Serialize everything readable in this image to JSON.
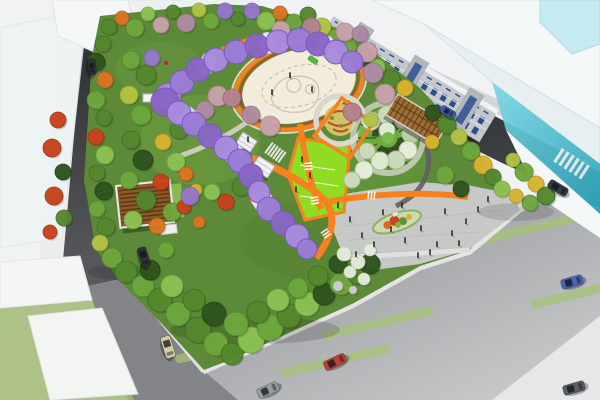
{
  "meta": {
    "scene_label": "aerial-render-urban-pocket-park-masterplan",
    "canvas": {
      "width": 600,
      "height": 400
    }
  },
  "palette": {
    "background": "#f1f2f3",
    "park_green": "#5d8a38",
    "lime_lawn": "#8fdc22",
    "path_orange": "#f5821e",
    "path_red_stripe": "#e03410",
    "plaza_cream": "#f2ecdb",
    "plaza_pattern": "#c9c2b0",
    "corner_plaza_gray": "#c7c9c7",
    "asphalt_dark": "#2b2d30",
    "road_mid": "#828487",
    "sidewalk": "#ececee",
    "median_green": "#a6c473",
    "glass_cyan": "#3fb6c9",
    "glass_white": "#f3f7f8",
    "facade_gray": "#c4c8cc",
    "window_blue": "#2e4f8e",
    "wood_brown": "#8a5a28",
    "pergola_wood": "#9c6830",
    "wisteria_light": "#a98ae0",
    "wisteria_mid": "#9b7cd8",
    "wisteria_dark": "#8a66c6",
    "people_dark": "#23252a",
    "trees": {
      "dk": {
        "f": "#2f541e",
        "s": "#24401a"
      },
      "g2": {
        "f": "#55882e",
        "s": "#3f6a22"
      },
      "g3": {
        "f": "#6ea83c",
        "s": "#54862c"
      },
      "g4": {
        "f": "#8cc254",
        "s": "#6da43c"
      },
      "yg": {
        "f": "#b4c445",
        "s": "#93a433"
      },
      "yl": {
        "f": "#d9b430",
        "s": "#b59423"
      },
      "or": {
        "f": "#dd7524",
        "s": "#b95a18"
      },
      "rd": {
        "f": "#c8431c",
        "s": "#a33314"
      },
      "pk": {
        "f": "#c9a2ac",
        "s": "#ab8390"
      },
      "pk2": {
        "f": "#b5838f",
        "s": "#966674"
      },
      "mv": {
        "f": "#b08ba4",
        "s": "#92708a"
      },
      "pu": {
        "f": "#9678cc",
        "s": "#7b5cb4"
      },
      "wh": {
        "f": "#e7ecdf",
        "s": "#c6d2b8"
      },
      "rk": {
        "f": "#cfd2cc",
        "s": "#aab0a8"
      }
    }
  },
  "scene": {
    "trees": [
      [
        109,
        27,
        8,
        "g2"
      ],
      [
        122,
        18,
        7,
        "or"
      ],
      [
        135,
        28,
        9,
        "g3"
      ],
      [
        148,
        14,
        7,
        "g4"
      ],
      [
        161,
        25,
        8,
        "pk"
      ],
      [
        173,
        12,
        7,
        "g2"
      ],
      [
        186,
        23,
        9,
        "mv"
      ],
      [
        199,
        10,
        7,
        "yg"
      ],
      [
        211,
        21,
        8,
        "g3"
      ],
      [
        225,
        11,
        8,
        "pu"
      ],
      [
        238,
        19,
        7,
        "g2"
      ],
      [
        252,
        11,
        8,
        "pu"
      ],
      [
        266,
        21,
        9,
        "g4"
      ],
      [
        280,
        13,
        7,
        "or"
      ],
      [
        294,
        22,
        8,
        "g3"
      ],
      [
        308,
        15,
        8,
        "g2"
      ],
      [
        322,
        27,
        9,
        "yg"
      ],
      [
        336,
        37,
        8,
        "g3"
      ],
      [
        103,
        44,
        8,
        "g2"
      ],
      [
        96,
        62,
        9,
        "dk"
      ],
      [
        105,
        80,
        8,
        "or"
      ],
      [
        96,
        100,
        9,
        "g3"
      ],
      [
        104,
        118,
        8,
        "g2"
      ],
      [
        96,
        137,
        8,
        "rd"
      ],
      [
        105,
        155,
        9,
        "g4"
      ],
      [
        97,
        173,
        8,
        "g2"
      ],
      [
        104,
        191,
        9,
        "dk"
      ],
      [
        97,
        209,
        8,
        "g3"
      ],
      [
        106,
        227,
        9,
        "g2"
      ],
      [
        100,
        243,
        8,
        "yg"
      ],
      [
        112,
        258,
        10,
        "g3"
      ],
      [
        126,
        272,
        11,
        "g2"
      ],
      [
        143,
        286,
        11,
        "g3"
      ],
      [
        160,
        300,
        12,
        "g2"
      ],
      [
        178,
        314,
        12,
        "g3"
      ],
      [
        198,
        330,
        13,
        "g2"
      ],
      [
        216,
        344,
        12,
        "g3"
      ],
      [
        232,
        354,
        11,
        "g2"
      ],
      [
        251,
        340,
        13,
        "g4"
      ],
      [
        270,
        328,
        13,
        "g3"
      ],
      [
        289,
        316,
        12,
        "g2"
      ],
      [
        307,
        304,
        12,
        "g4"
      ],
      [
        324,
        294,
        11,
        "dk"
      ],
      [
        341,
        284,
        11,
        "g3"
      ],
      [
        357,
        274,
        10,
        "g2"
      ],
      [
        370,
        264,
        10,
        "dk"
      ],
      [
        150,
        270,
        10,
        "dk"
      ],
      [
        172,
        286,
        11,
        "g4"
      ],
      [
        194,
        300,
        11,
        "g2"
      ],
      [
        214,
        314,
        12,
        "dk"
      ],
      [
        236,
        324,
        12,
        "g3"
      ],
      [
        258,
        312,
        11,
        "g2"
      ],
      [
        278,
        300,
        11,
        "g4"
      ],
      [
        298,
        288,
        10,
        "g3"
      ],
      [
        318,
        276,
        10,
        "g2"
      ],
      [
        338,
        264,
        9,
        "dk"
      ],
      [
        344,
        254,
        7,
        "wh"
      ],
      [
        358,
        262,
        7,
        "wh"
      ],
      [
        370,
        250,
        6,
        "wh"
      ],
      [
        350,
        272,
        6,
        "wh"
      ],
      [
        364,
        279,
        6,
        "wh"
      ],
      [
        338,
        286,
        5,
        "rk"
      ],
      [
        353,
        290,
        4,
        "rk"
      ],
      [
        349,
        47,
        8,
        "g3"
      ],
      [
        363,
        57,
        9,
        "dk"
      ],
      [
        377,
        67,
        8,
        "g4"
      ],
      [
        391,
        79,
        9,
        "g2"
      ],
      [
        405,
        88,
        8,
        "yl"
      ],
      [
        433,
        113,
        8,
        "dk"
      ],
      [
        447,
        125,
        9,
        "g2"
      ],
      [
        459,
        137,
        8,
        "yg"
      ],
      [
        471,
        151,
        9,
        "g3"
      ],
      [
        483,
        165,
        9,
        "yl"
      ],
      [
        493,
        177,
        8,
        "g2"
      ],
      [
        502,
        189,
        8,
        "g4"
      ],
      [
        513,
        160,
        7,
        "yg"
      ],
      [
        524,
        172,
        9,
        "g3"
      ],
      [
        536,
        184,
        8,
        "yl"
      ],
      [
        546,
        196,
        9,
        "g2"
      ],
      [
        530,
        203,
        8,
        "g3"
      ],
      [
        516,
        196,
        7,
        "yl"
      ],
      [
        218,
        96,
        10,
        "pk"
      ],
      [
        205,
        110,
        9,
        "mv"
      ],
      [
        281,
        30,
        9,
        "pk"
      ],
      [
        311,
        27,
        9,
        "pk2"
      ],
      [
        345,
        32,
        9,
        "pk"
      ],
      [
        367,
        52,
        10,
        "pk"
      ],
      [
        373,
        73,
        10,
        "mv"
      ],
      [
        385,
        94,
        10,
        "pk"
      ],
      [
        352,
        112,
        9,
        "pk2"
      ],
      [
        251,
        115,
        9,
        "mv"
      ],
      [
        270,
        126,
        10,
        "pk"
      ],
      [
        232,
        98,
        9,
        "pk2"
      ],
      [
        360,
        34,
        8,
        "mv"
      ],
      [
        131,
        60,
        9,
        "g3"
      ],
      [
        146,
        75,
        10,
        "g2"
      ],
      [
        129,
        95,
        9,
        "yg"
      ],
      [
        141,
        115,
        10,
        "g3"
      ],
      [
        131,
        140,
        9,
        "g2"
      ],
      [
        143,
        160,
        10,
        "dk"
      ],
      [
        129,
        180,
        9,
        "g3"
      ],
      [
        146,
        200,
        10,
        "g2"
      ],
      [
        133,
        220,
        9,
        "g4"
      ],
      [
        157,
        226,
        8,
        "or"
      ],
      [
        172,
        212,
        9,
        "g3"
      ],
      [
        161,
        182,
        8,
        "rd"
      ],
      [
        176,
        162,
        9,
        "g4"
      ],
      [
        163,
        142,
        8,
        "yl"
      ],
      [
        179,
        130,
        9,
        "g2"
      ],
      [
        272,
        212,
        9,
        "g3"
      ],
      [
        257,
        197,
        8,
        "or"
      ],
      [
        241,
        187,
        9,
        "g2"
      ],
      [
        226,
        202,
        8,
        "rd"
      ],
      [
        212,
        192,
        8,
        "g4"
      ],
      [
        186,
        174,
        7,
        "or"
      ],
      [
        196,
        190,
        6,
        "yl"
      ],
      [
        184,
        207,
        7,
        "rd"
      ],
      [
        199,
        222,
        6,
        "or"
      ],
      [
        432,
        142,
        7,
        "yl"
      ],
      [
        371,
        120,
        7,
        "yg"
      ],
      [
        445,
        175,
        9,
        "g3"
      ],
      [
        461,
        189,
        8,
        "dk"
      ],
      [
        152,
        58,
        8,
        "pu"
      ],
      [
        190,
        196,
        9,
        "pu"
      ],
      [
        166,
        250,
        8,
        "g3"
      ],
      [
        58,
        120,
        8,
        "rd"
      ],
      [
        52,
        148,
        9,
        "rd"
      ],
      [
        63,
        172,
        8,
        "dk"
      ],
      [
        54,
        196,
        9,
        "rd"
      ],
      [
        64,
        218,
        8,
        "g2"
      ],
      [
        50,
        232,
        7,
        "rd"
      ]
    ],
    "wisteria_arc": [
      [
        168,
        96,
        13
      ],
      [
        182,
        82,
        12
      ],
      [
        198,
        70,
        12
      ],
      [
        216,
        60,
        12
      ],
      [
        236,
        52,
        12
      ],
      [
        257,
        46,
        12
      ],
      [
        278,
        42,
        12
      ],
      [
        299,
        40,
        12
      ],
      [
        318,
        44,
        12
      ],
      [
        336,
        52,
        12
      ],
      [
        352,
        62,
        11
      ]
    ],
    "wisteria_tunnel": [
      [
        165,
        102,
        14
      ],
      [
        179,
        113,
        12
      ],
      [
        194,
        124,
        12
      ],
      [
        210,
        136,
        12
      ],
      [
        226,
        148,
        12
      ],
      [
        240,
        161,
        12
      ],
      [
        251,
        176,
        12
      ],
      [
        259,
        192,
        11
      ],
      [
        269,
        209,
        12
      ],
      [
        283,
        223,
        12
      ],
      [
        297,
        236,
        12
      ],
      [
        307,
        249,
        10
      ]
    ],
    "tunnel_ribs": [
      [
        187,
        117,
        40
      ],
      [
        233,
        153,
        42
      ],
      [
        262,
        200,
        55
      ],
      [
        207,
        64,
        35
      ],
      [
        268,
        43,
        20
      ],
      [
        327,
        47,
        -20
      ]
    ],
    "cars": [
      [
        144,
        257,
        72,
        "#2e3237",
        20,
        9
      ],
      [
        168,
        347,
        73,
        "#d6cfa4",
        22,
        10
      ],
      [
        335,
        362,
        -25,
        "#bd4038",
        23,
        10
      ],
      [
        572,
        282,
        -16,
        "#4a66b0",
        22,
        10
      ],
      [
        558,
        188,
        31,
        "#34383f",
        21,
        9
      ],
      [
        448,
        112,
        31,
        "#3f5ea6",
        16,
        8
      ],
      [
        268,
        390,
        -25,
        "#9a9da2",
        22,
        10
      ],
      [
        574,
        388,
        -16,
        "#5a5d62",
        22,
        10
      ],
      [
        92,
        67,
        82,
        "#2e3338",
        16,
        8
      ]
    ],
    "people": [
      [
        362,
        238
      ],
      [
        374,
        247
      ],
      [
        391,
        232
      ],
      [
        405,
        243
      ],
      [
        421,
        231
      ],
      [
        437,
        247
      ],
      [
        452,
        236
      ],
      [
        466,
        224
      ],
      [
        383,
        215
      ],
      [
        402,
        208
      ],
      [
        356,
        257
      ],
      [
        418,
        258
      ],
      [
        445,
        214
      ],
      [
        478,
        212
      ],
      [
        350,
        222
      ],
      [
        430,
        255
      ],
      [
        459,
        246
      ],
      [
        290,
        78
      ],
      [
        312,
        92
      ],
      [
        272,
        95
      ],
      [
        302,
        162
      ],
      [
        310,
        178
      ],
      [
        296,
        192
      ],
      [
        248,
        142
      ],
      [
        338,
        208
      ],
      [
        488,
        202
      ]
    ],
    "medians": [
      [
        230,
        347
      ],
      [
        335,
        361
      ],
      [
        378,
        323
      ],
      [
        520,
        231
      ],
      [
        585,
        292
      ]
    ],
    "median_angle": -13,
    "median_size": {
      "length": 112,
      "width": 9
    }
  }
}
